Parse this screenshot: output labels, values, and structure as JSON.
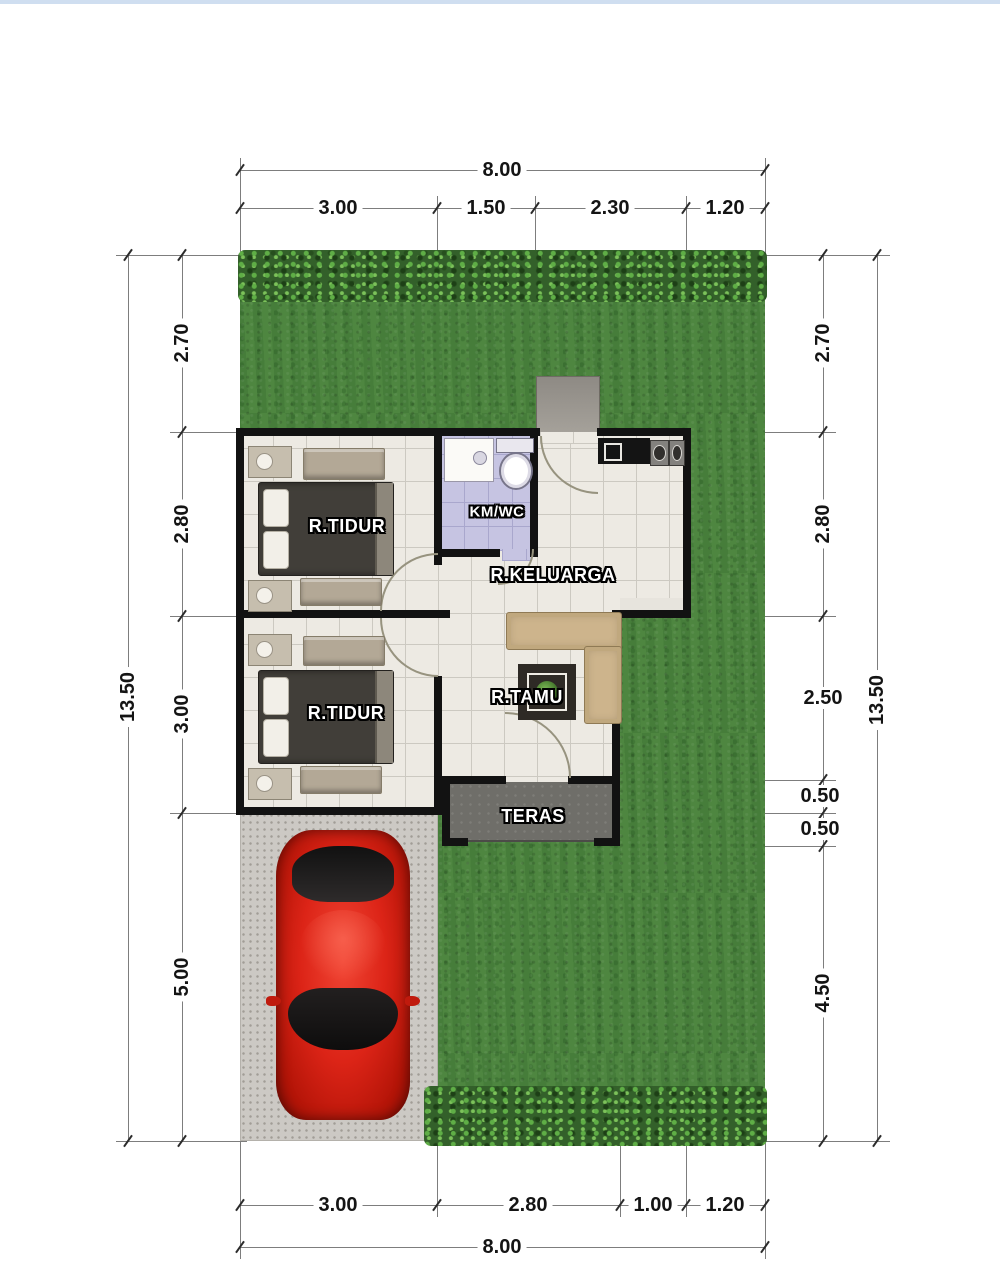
{
  "plan": {
    "dims": {
      "top_total": "8.00",
      "top_segments": [
        "3.00",
        "1.50",
        "2.30",
        "1.20"
      ],
      "bottom_segments": [
        "3.00",
        "2.80",
        "1.00",
        "1.20"
      ],
      "bottom_total": "8.00",
      "left_total": "13.50",
      "left_segments": [
        "2.70",
        "2.80",
        "3.00",
        "5.00"
      ],
      "right_segments": [
        "2.70",
        "2.80",
        "2.50",
        "0.50",
        "0.50",
        "4.50"
      ],
      "right_total": "13.50"
    },
    "rooms": {
      "bedroom_top": "R.TIDUR",
      "bedroom_bottom": "R.TIDUR",
      "bathroom": "KM/WC",
      "family_room": "R.KELUARGA",
      "living_room": "R.TAMU",
      "terrace": "TERAS"
    },
    "colors": {
      "grass": "#4c8440",
      "hedge": "#33602a",
      "driveway": "#ccc9c4",
      "wall": "#121212",
      "floor": "#edeae3",
      "bathroom_floor": "#c6c4e2",
      "terrace_floor": "#6f6e69",
      "car": "#dc2417",
      "sofa": "#cdb48c",
      "bed": "#413e39"
    }
  }
}
